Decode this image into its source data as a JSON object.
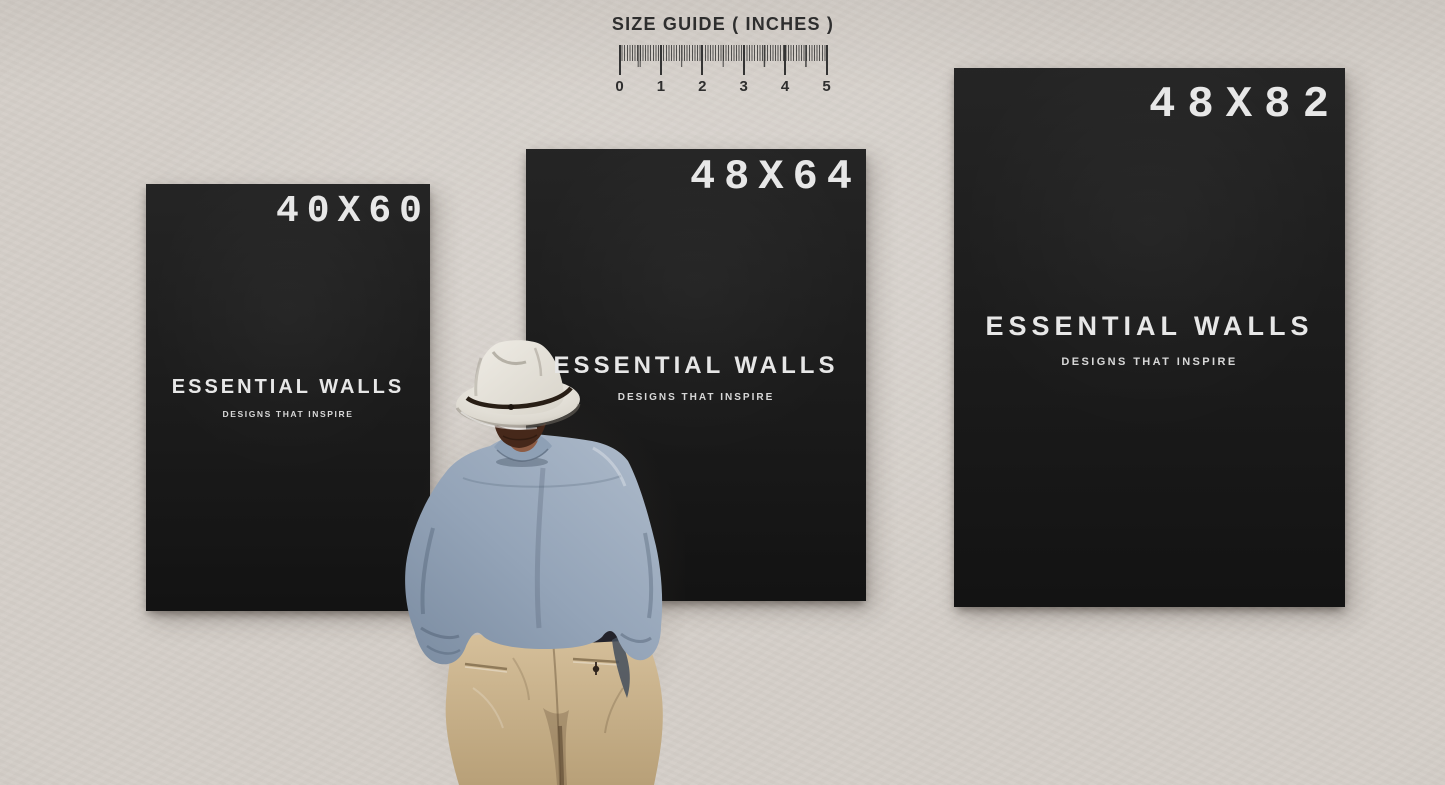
{
  "size_guide": {
    "title": "SIZE GUIDE ( INCHES )",
    "unit_numbers": [
      "0",
      "1",
      "2",
      "3",
      "4",
      "5"
    ]
  },
  "posters": [
    {
      "size_label": "40X60",
      "brand": "ESSENTIAL WALLS",
      "tagline": "DESIGNS THAT INSPIRE"
    },
    {
      "size_label": "48X64",
      "brand": "ESSENTIAL WALLS",
      "tagline": "DESIGNS THAT INSPIRE"
    },
    {
      "size_label": "48X82",
      "brand": "ESSENTIAL WALLS",
      "tagline": "DESIGNS THAT INSPIRE"
    }
  ],
  "colors": {
    "wall": "#d5cfc9",
    "poster_background": "#181818",
    "poster_text": "#e7e7e7",
    "guide_ink": "#2e2e2e",
    "hat": "#ebe8e1",
    "hat_band": "#281e15",
    "hair": "#46281a",
    "shirt": "#98a7ba",
    "pants": "#c8b18b"
  }
}
